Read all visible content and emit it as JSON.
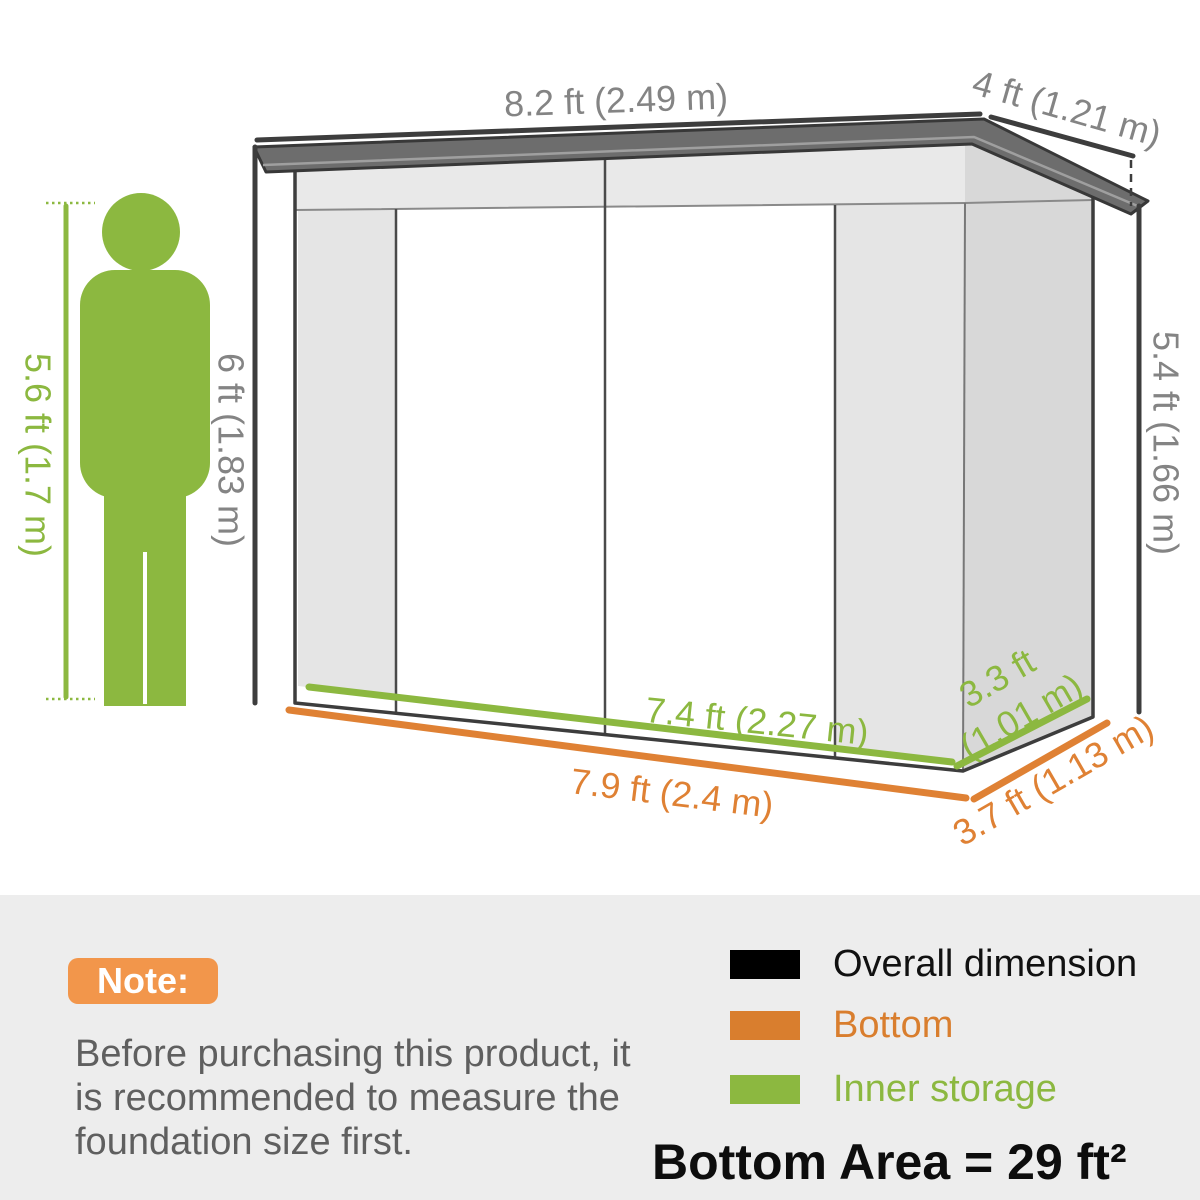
{
  "diagram": {
    "dimension_labels": {
      "roof_width": "8.2 ft (2.49 m)",
      "roof_depth": "4 ft (1.21 m)",
      "front_height": "6 ft (1.83 m)",
      "back_height": "5.4 ft (1.66 m)",
      "person_height": "5.6 ft (1.7 m)",
      "inner_width": "7.4 ft (2.27 m)",
      "bottom_width": "7.9 ft (2.4 m)",
      "inner_depth_line1": "3.3 ft",
      "inner_depth_line2": "(1.01 m)",
      "bottom_depth": "3.7 ft (1.13 m)"
    },
    "colors": {
      "overall_dimension": "#3d3d3d",
      "bottom_orange": "#df8134",
      "inner_storage_green": "#8cb840",
      "dimension_text_gray": "#848484",
      "roof_fill": "#6d6d6d",
      "wall_light": "#e9e9e9",
      "side_wall": "#d8d8d8",
      "panel_background": "#ededed"
    }
  },
  "note": {
    "badge": "Note:",
    "lines": [
      "Before purchasing this product, it",
      "is recommended to measure the",
      "foundation size first."
    ]
  },
  "legend": {
    "items": [
      {
        "label": "Overall dimension",
        "color": "#000000"
      },
      {
        "label": "Bottom",
        "color": "#d97e2e"
      },
      {
        "label": "Inner storage",
        "color": "#8cb840"
      }
    ],
    "bottom_area": "Bottom Area = 29 ft² (2.7 m²)"
  }
}
